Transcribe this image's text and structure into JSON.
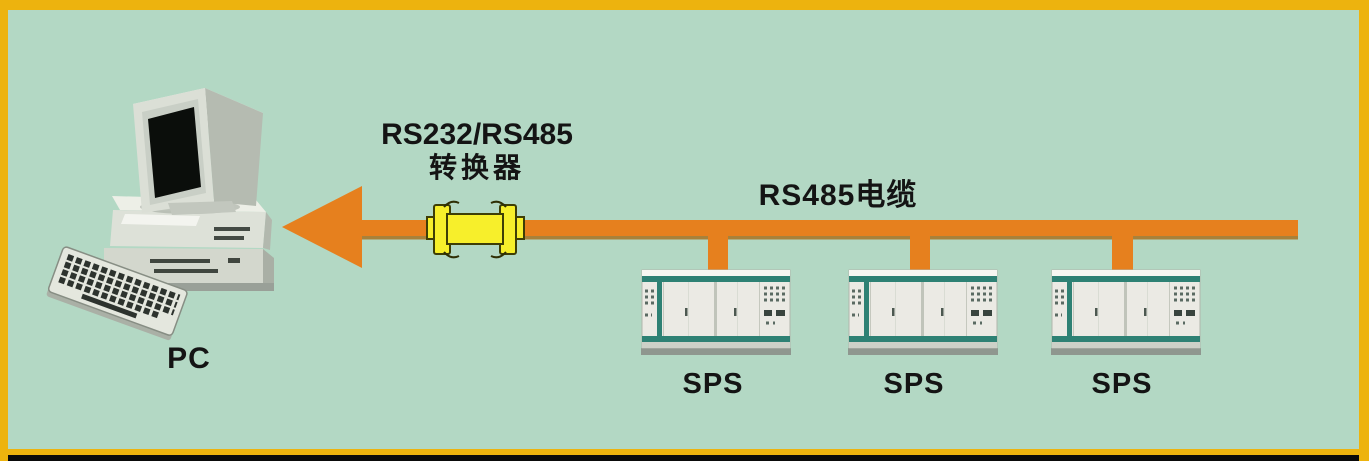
{
  "canvas": {
    "background_color": "#b3d8c4",
    "frame_color": "#edb30e",
    "frame_bottom_strip_color": "#0a0a0a"
  },
  "pc": {
    "label": "PC"
  },
  "converter": {
    "label_line1": "RS232/RS485",
    "label_line2": "转换器",
    "body_color": "#f7ef2b",
    "outline_color": "#3e3e06"
  },
  "bus": {
    "label": "RS485电缆",
    "color": "#e6801e",
    "arrow_direction": "left"
  },
  "devices": [
    {
      "label": "SPS"
    },
    {
      "label": "SPS"
    },
    {
      "label": "SPS"
    }
  ]
}
